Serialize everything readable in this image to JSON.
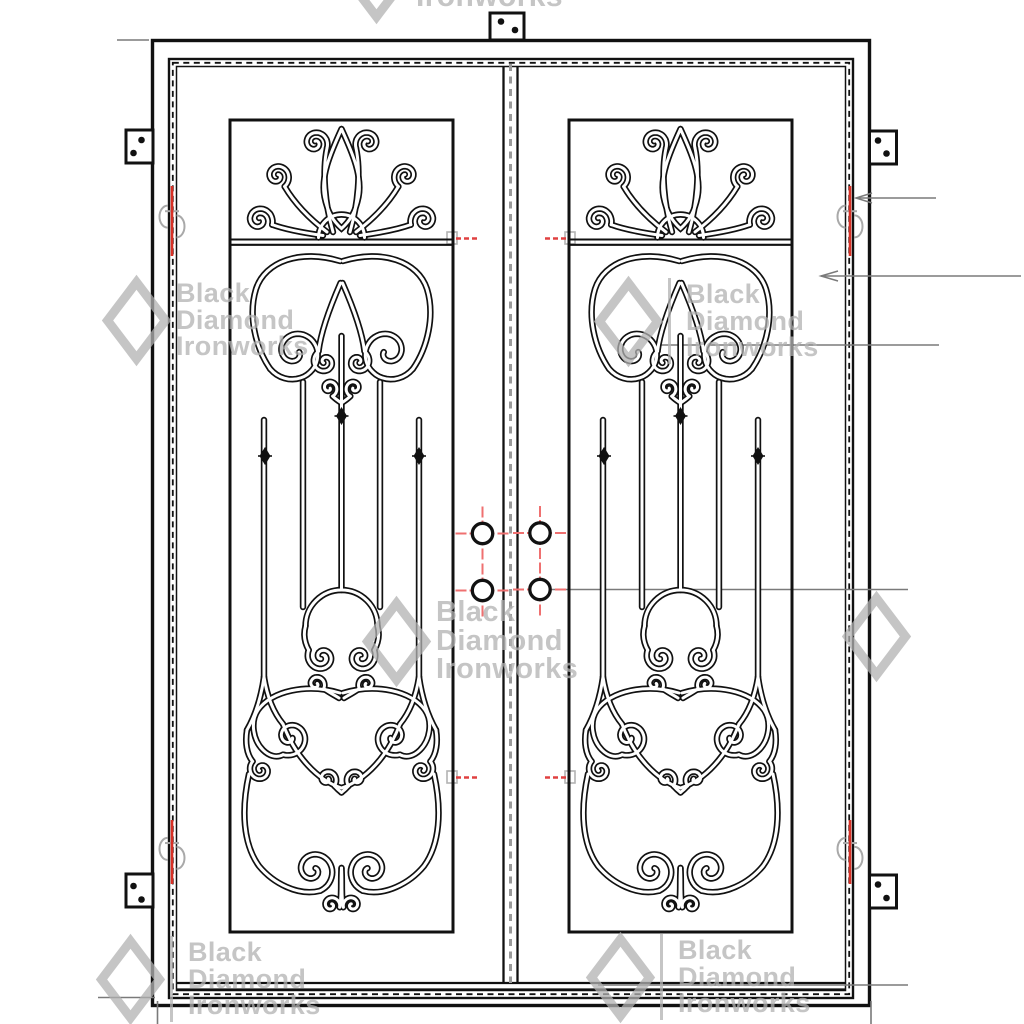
{
  "watermark": {
    "line1": "Black",
    "line2": "Diamond",
    "line3": "Ironworks"
  },
  "colors": {
    "background": "#ffffff",
    "ink": "#111111",
    "annotation_gray": "#7a7a7a",
    "centerline_gray": "#9a9a9a",
    "hinge_red": "#d93025",
    "marker_red": "#e04040",
    "crosshair_red": "#ef7070",
    "hinge_detail_gray": "#a9a9a9",
    "watermark_gray": "rgba(178,178,178,0.75)"
  },
  "drawing": {
    "door_leaves": 2,
    "deadbolt_prep_holes": 4,
    "hinge_marks": 4,
    "anchor_clips": 5,
    "ornamental_panels": 2
  }
}
